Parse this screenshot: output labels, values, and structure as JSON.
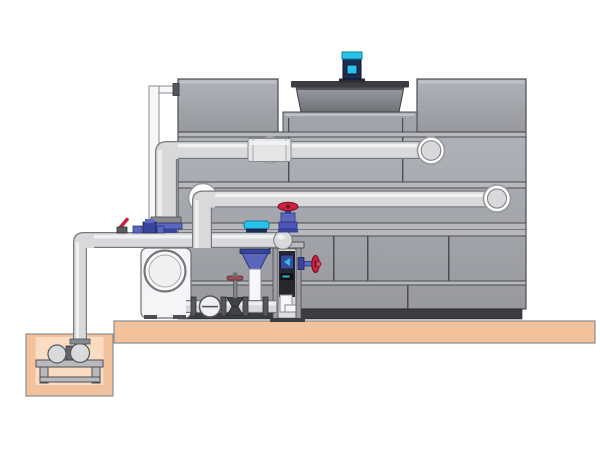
{
  "meta": {
    "figure_type": "technical-illustration",
    "subject": "cooling-tower-with-pump-skid-and-sump",
    "canvas": {
      "width": 600,
      "height": 450
    },
    "visible_text": []
  },
  "colors": {
    "background": "#ffffff",
    "structure_gray": "#a2a4ab",
    "structure_gray_light": "#b6b8be",
    "structure_line": "#4b4d53",
    "structure_base_dark": "#3a3c42",
    "fan_cowl_rim": "#3b3d43",
    "pipe_mid": "#d8d9db",
    "pipe_light": "#f1f2f4",
    "pipe_outline": "#77787b",
    "flange_white": "#ffffff",
    "slab_tan": "#f2c29c",
    "slab_tan_light": "#f9dcc2",
    "slab_outline": "#8a8b8d",
    "motor_cyan": "#27c3ea",
    "motor_navy": "#1b2b52",
    "valve_red": "#cc2040",
    "valve_blue": "#5a66c0",
    "valve_blue_dark": "#38449a",
    "panel_dark": "#26282e",
    "metal_gray": "#b8babd"
  },
  "components": [
    {
      "name": "cooling-tower-structure",
      "kind": "casing-panels"
    },
    {
      "name": "fan-cowl",
      "kind": "shroud"
    },
    {
      "name": "fan-motor",
      "kind": "motor",
      "accent": "cyan"
    },
    {
      "name": "overflow-standpipe",
      "kind": "pipe"
    },
    {
      "name": "upper-supply-pipe",
      "kind": "pipe-with-elbows"
    },
    {
      "name": "middle-return-pipe",
      "kind": "pipe-with-elbows"
    },
    {
      "name": "lower-discharge-pipe",
      "kind": "pipe-with-dome-cap"
    },
    {
      "name": "globe-valve-red-handwheel",
      "kind": "valve",
      "accent": "red"
    },
    {
      "name": "side-valve-red-handwheel",
      "kind": "valve",
      "accent": "red"
    },
    {
      "name": "ball-valve-red-lever",
      "kind": "valve",
      "accent": "red"
    },
    {
      "name": "dosing-manifold",
      "kind": "fittings",
      "accent": "blue"
    },
    {
      "name": "sensor-cap",
      "kind": "instrument",
      "accent": "cyan"
    },
    {
      "name": "suction-diffuser-cone",
      "kind": "strainer",
      "accent": "blue"
    },
    {
      "name": "check-valve",
      "kind": "valve"
    },
    {
      "name": "gate-valve",
      "kind": "valve"
    },
    {
      "name": "pump-volute",
      "kind": "pump"
    },
    {
      "name": "support-column",
      "kind": "frame"
    },
    {
      "name": "concrete-slab",
      "kind": "foundation"
    },
    {
      "name": "sump-pit",
      "kind": "foundation"
    },
    {
      "name": "sump-pump-on-stand",
      "kind": "pump"
    }
  ]
}
